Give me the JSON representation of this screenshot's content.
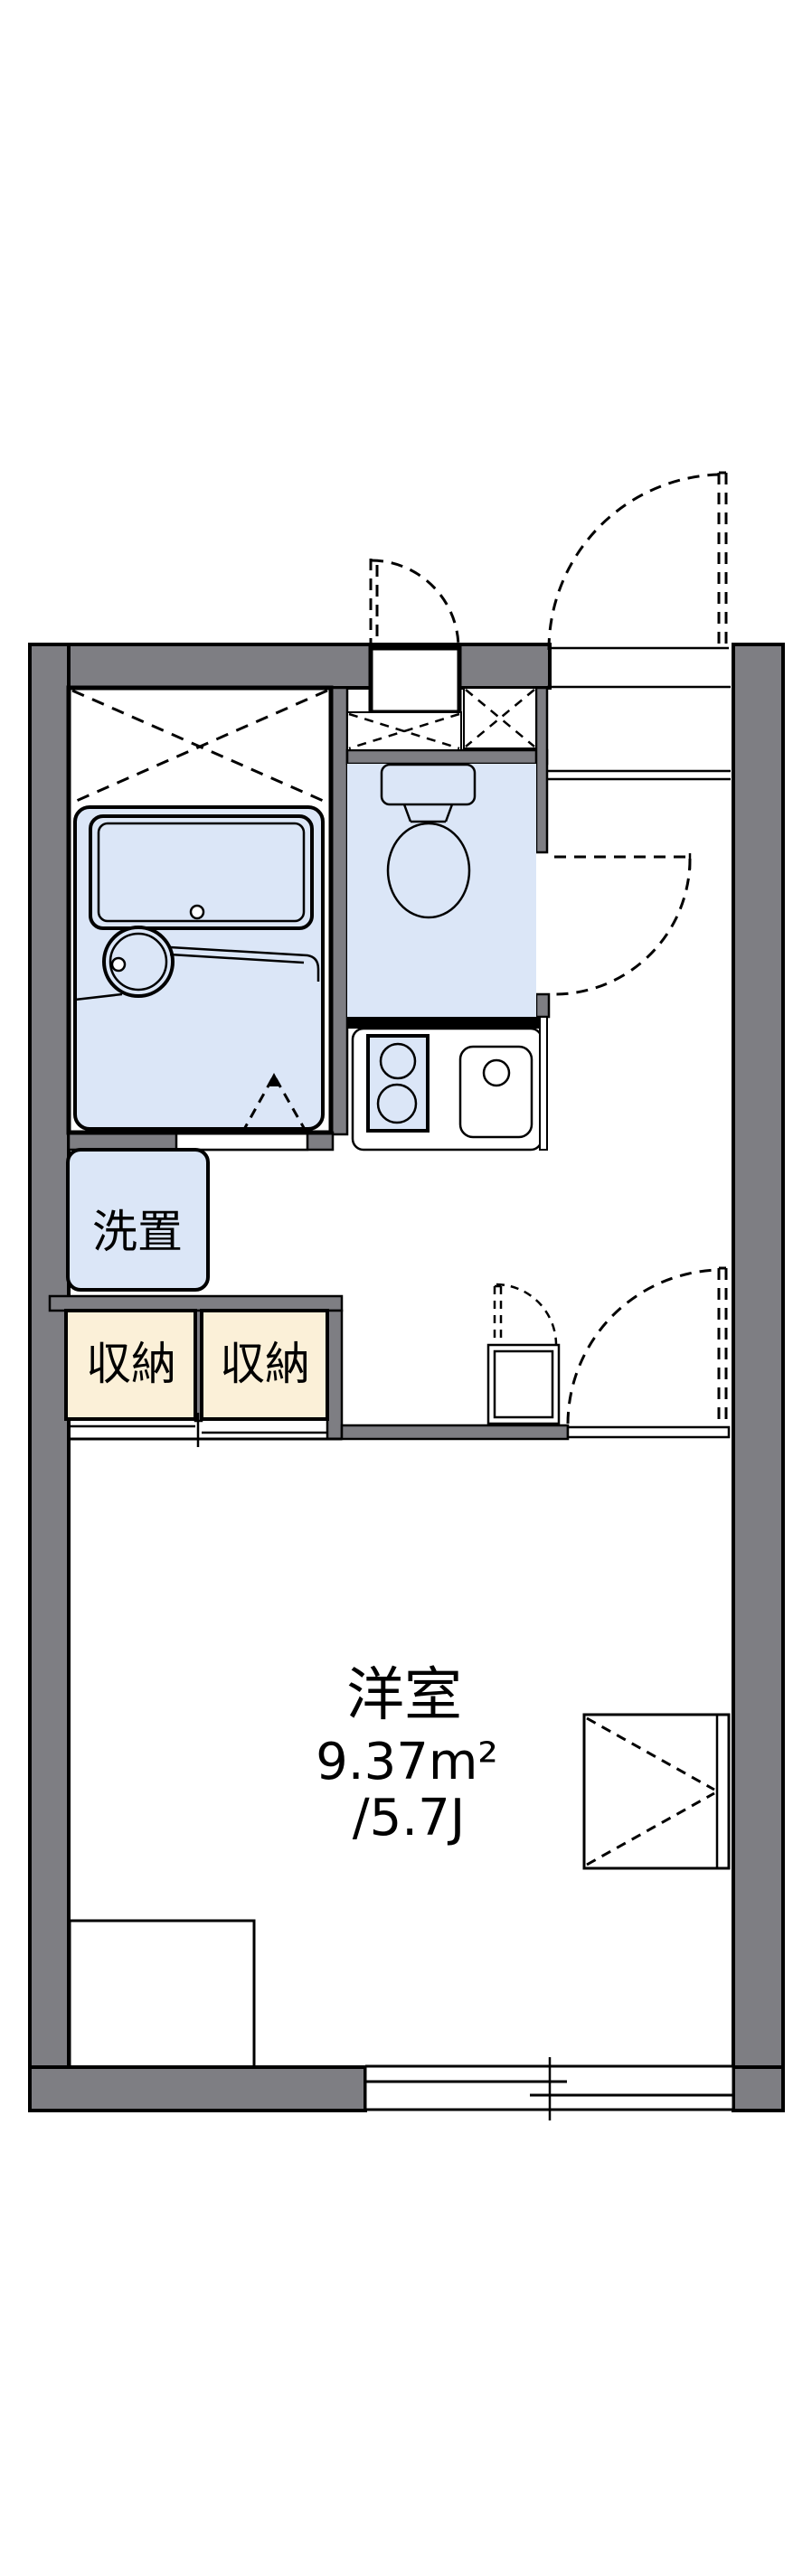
{
  "rooms": {
    "main_room": {
      "label": "洋室",
      "area_sqm": "9.37m²",
      "area_tatami": "/5.7J"
    },
    "laundry": {
      "label": "洗置"
    },
    "closets": [
      {
        "label": "収納"
      },
      {
        "label": "収納"
      }
    ]
  },
  "colors": {
    "wall": "#7e7e83",
    "fixture_fill": "#dbe6f7",
    "storage_fill": "#fbf0d8",
    "line": "#000000",
    "background": "#ffffff"
  },
  "features": {
    "bath": "unit-bath-with-tub-and-basin",
    "bath_door": "folding-door-dashed-triangle",
    "overhead_storage": "dashed-x-upper-cabinet",
    "meter_box": "meter-box-niche",
    "toilet": "toilet-with-tank",
    "kitchen": "two-burner-stove-and-sink-counter",
    "entrance_door": "outward-swing-dashed-arc",
    "toilet_door": "outward-swing-dashed-arc",
    "utility_box": "water-heater-box-with-flap-door",
    "main_room_door": "swing-door-dashed-arc",
    "closet_front": "double-sliding-doors",
    "bay_unit": "window-side-counter-with-dashed-v",
    "bed_space": "floor-rectangle",
    "window": "double-sliding-window"
  }
}
